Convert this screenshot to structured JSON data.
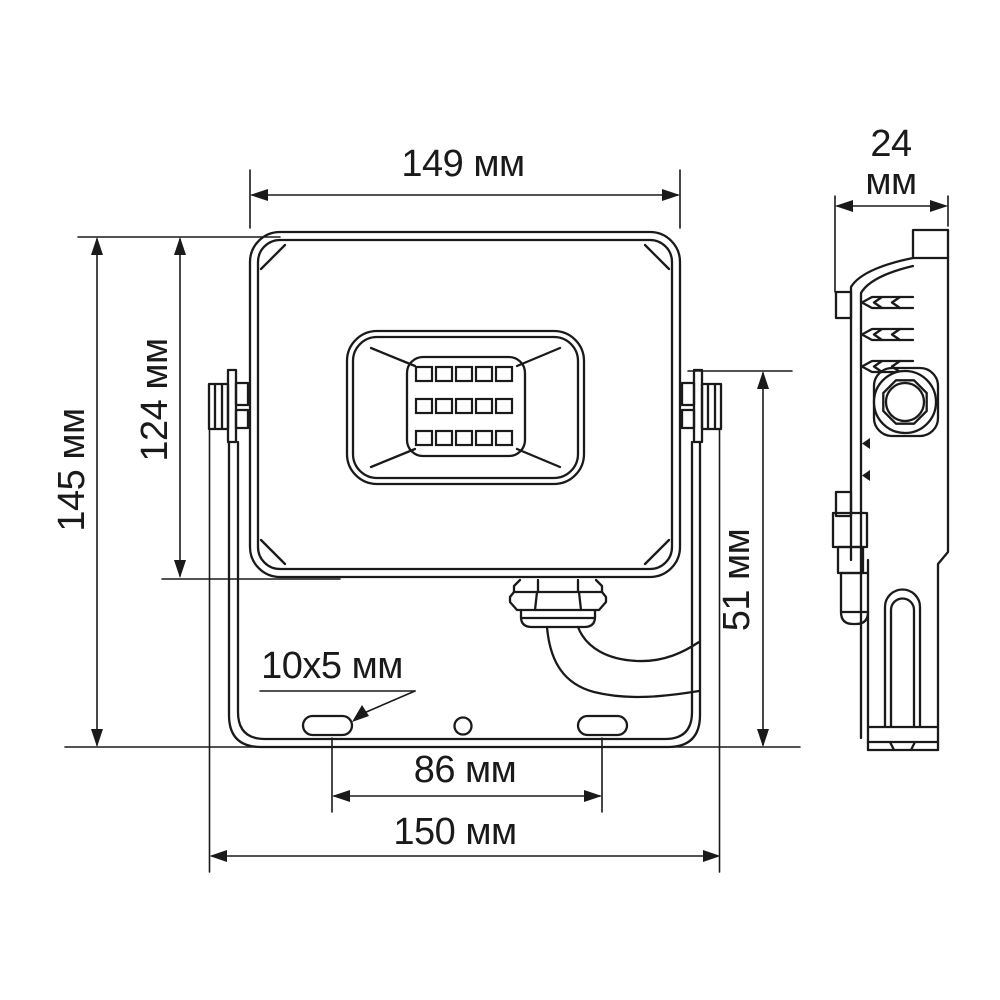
{
  "drawing": {
    "type": "technical-dimension-drawing",
    "subject": "LED floodlight — front and side orthographic views",
    "line_color": "#1a1a1a",
    "background": "#ffffff",
    "labels": {
      "front_width": "149 мм",
      "depth_value": "24",
      "depth_unit": "мм",
      "overall_height": "145 мм",
      "body_height": "124 мм",
      "bracket_height": "51 мм",
      "slot_size": "10x5 мм",
      "slot_spacing": "86 мм",
      "overall_width": "150 мм"
    },
    "front_view": {
      "led_rows": 3,
      "led_columns": 5,
      "mounting_slots": 2,
      "center_holes": 1
    }
  }
}
